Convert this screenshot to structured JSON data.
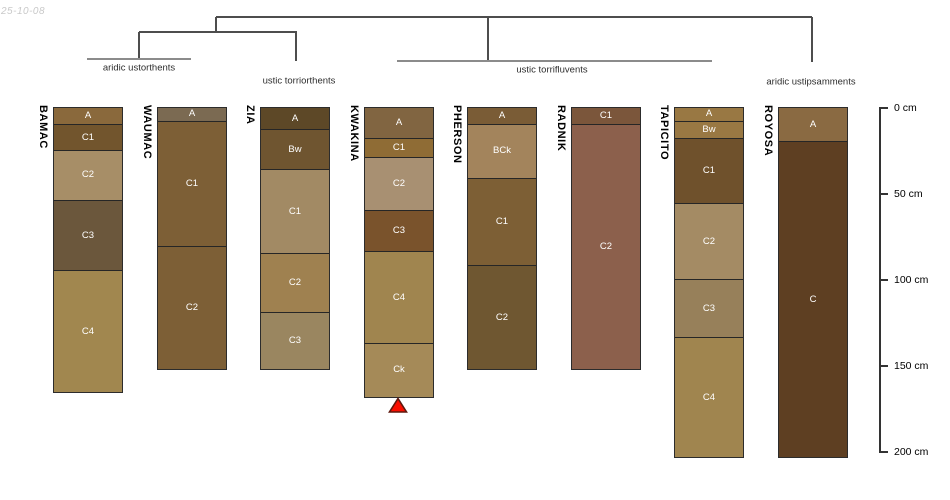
{
  "figure": {
    "date_label": "25-10-08"
  },
  "chart_data": {
    "type": "soil-profile-dendrogram",
    "depth_axis": {
      "unit": "cm",
      "ticks": [
        0,
        50,
        100,
        150,
        200
      ],
      "labels": [
        "0 cm",
        "50 cm",
        "100 cm",
        "150 cm",
        "200 cm"
      ]
    },
    "clusters": [
      {
        "label": "aridic ustorthents",
        "members": [
          "BAMAC",
          "WAUMAC"
        ]
      },
      {
        "label": "ustic torriorthents",
        "members": [
          "ZIA"
        ]
      },
      {
        "label": "ustic torrifluvents",
        "members": [
          "KWAKINA",
          "PHERSON",
          "RADNIK",
          "TAPICITO"
        ]
      },
      {
        "label": "aridic ustipsamments",
        "members": [
          "ROYOSA"
        ]
      }
    ],
    "marker": {
      "profile": "KWAKINA",
      "shape": "red-triangle",
      "color": "#F90E00"
    },
    "profiles": [
      {
        "name": "BAMAC",
        "marker": false,
        "horizons": [
          {
            "label": "A",
            "top_cm": 0,
            "bottom_cm": 10,
            "color": "#8A693C"
          },
          {
            "label": "C1",
            "top_cm": 10,
            "bottom_cm": 25,
            "color": "#72552D"
          },
          {
            "label": "C2",
            "top_cm": 25,
            "bottom_cm": 54,
            "color": "#A78E67"
          },
          {
            "label": "C3",
            "top_cm": 54,
            "bottom_cm": 95,
            "color": "#6B573C"
          },
          {
            "label": "C4",
            "top_cm": 95,
            "bottom_cm": 165,
            "color": "#A1874F"
          }
        ]
      },
      {
        "name": "WAUMAC",
        "marker": false,
        "horizons": [
          {
            "label": "A",
            "top_cm": 0,
            "bottom_cm": 8,
            "color": "#7B6A52"
          },
          {
            "label": "C1",
            "top_cm": 8,
            "bottom_cm": 81,
            "color": "#7D5F36"
          },
          {
            "label": "C2",
            "top_cm": 81,
            "bottom_cm": 152,
            "color": "#7D5F36"
          }
        ]
      },
      {
        "name": "ZIA",
        "marker": false,
        "horizons": [
          {
            "label": "A",
            "top_cm": 0,
            "bottom_cm": 13,
            "color": "#5D4827"
          },
          {
            "label": "Bw",
            "top_cm": 13,
            "bottom_cm": 36,
            "color": "#6F5530"
          },
          {
            "label": "C1",
            "top_cm": 36,
            "bottom_cm": 85,
            "color": "#A28A64"
          },
          {
            "label": "C2",
            "top_cm": 85,
            "bottom_cm": 119,
            "color": "#9F8150"
          },
          {
            "label": "C3",
            "top_cm": 119,
            "bottom_cm": 152,
            "color": "#9A8660"
          }
        ]
      },
      {
        "name": "KWAKINA",
        "marker": true,
        "horizons": [
          {
            "label": "A",
            "top_cm": 0,
            "bottom_cm": 18,
            "color": "#816541"
          },
          {
            "label": "C1",
            "top_cm": 18,
            "bottom_cm": 29,
            "color": "#8F6C35"
          },
          {
            "label": "C2",
            "top_cm": 29,
            "bottom_cm": 60,
            "color": "#A89072"
          },
          {
            "label": "C3",
            "top_cm": 60,
            "bottom_cm": 84,
            "color": "#7A532C"
          },
          {
            "label": "C4",
            "top_cm": 84,
            "bottom_cm": 137,
            "color": "#A0854F"
          },
          {
            "label": "Ck",
            "top_cm": 137,
            "bottom_cm": 168,
            "color": "#A58A58"
          }
        ]
      },
      {
        "name": "PHERSON",
        "marker": false,
        "horizons": [
          {
            "label": "A",
            "top_cm": 0,
            "bottom_cm": 10,
            "color": "#7A5C36"
          },
          {
            "label": "BCk",
            "top_cm": 10,
            "bottom_cm": 41,
            "color": "#A3845C"
          },
          {
            "label": "C1",
            "top_cm": 41,
            "bottom_cm": 92,
            "color": "#7D5F35"
          },
          {
            "label": "C2",
            "top_cm": 92,
            "bottom_cm": 152,
            "color": "#6F5731"
          }
        ]
      },
      {
        "name": "RADNIK",
        "marker": false,
        "horizons": [
          {
            "label": "C1",
            "top_cm": 0,
            "bottom_cm": 10,
            "color": "#7B563B"
          },
          {
            "label": "C2",
            "top_cm": 10,
            "bottom_cm": 152,
            "color": "#8C604C"
          }
        ]
      },
      {
        "name": "TAPICITO",
        "marker": false,
        "horizons": [
          {
            "label": "A",
            "top_cm": 0,
            "bottom_cm": 8,
            "color": "#997843"
          },
          {
            "label": "Bw",
            "top_cm": 8,
            "bottom_cm": 18,
            "color": "#997843"
          },
          {
            "label": "C1",
            "top_cm": 18,
            "bottom_cm": 56,
            "color": "#6F512C"
          },
          {
            "label": "C2",
            "top_cm": 56,
            "bottom_cm": 100,
            "color": "#A48B64"
          },
          {
            "label": "C3",
            "top_cm": 100,
            "bottom_cm": 134,
            "color": "#97805A"
          },
          {
            "label": "C4",
            "top_cm": 134,
            "bottom_cm": 203,
            "color": "#A0854F"
          }
        ]
      },
      {
        "name": "ROYOSA",
        "marker": false,
        "horizons": [
          {
            "label": "A",
            "top_cm": 0,
            "bottom_cm": 20,
            "color": "#8A6A42"
          },
          {
            "label": "C",
            "top_cm": 20,
            "bottom_cm": 203,
            "color": "#5E3F22"
          }
        ]
      }
    ]
  }
}
